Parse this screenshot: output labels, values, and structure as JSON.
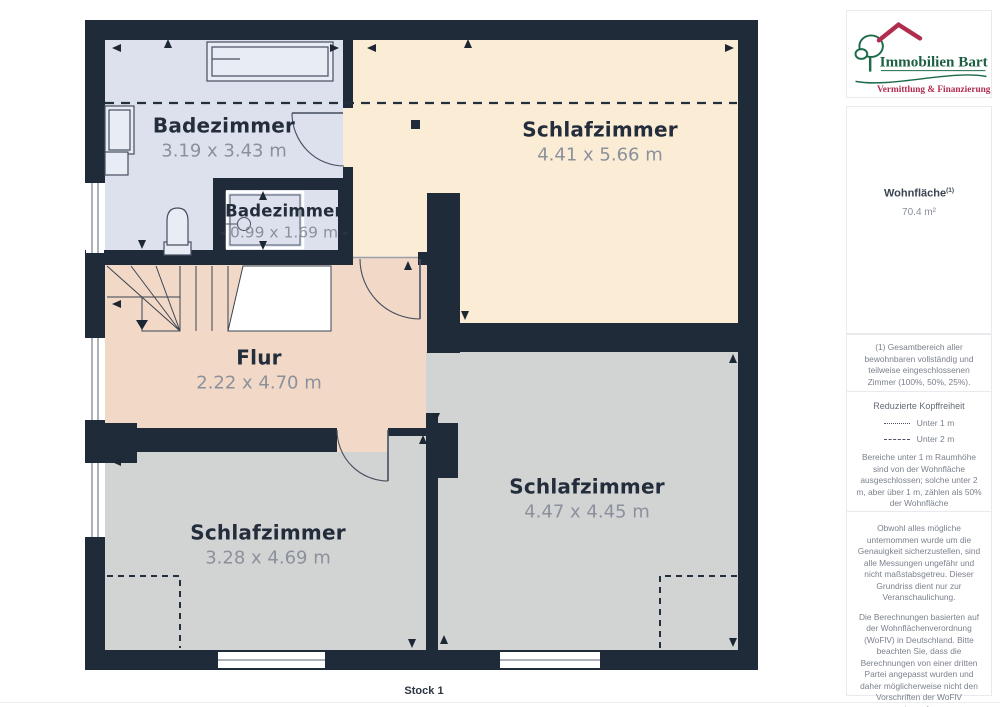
{
  "page": {
    "floor_label": "Stock 1"
  },
  "colors": {
    "wall": "#202b39",
    "bathroom_floor": "#dce1ed",
    "bedroom_cream": "#fbecd5",
    "flur_floor": "#f2d9c7",
    "bedroom_gray": "#d2d3d3",
    "brand_green": "#1d6a48",
    "brand_red": "#b02d4e"
  },
  "icons": {
    "dim_arrow_left": "◄",
    "dim_arrow_right": "►"
  },
  "branding": {
    "name": "Immobilien Bart",
    "tagline": "Vermittlung & Finanzierung"
  },
  "rooms": [
    {
      "name": "Badezimmer",
      "dims": "3.19 x 3.43 m"
    },
    {
      "name": "Badezimmer",
      "dims": "0.99 x 1.69 m"
    },
    {
      "name": "Schlafzimmer",
      "dims": "4.41 x 5.66 m"
    },
    {
      "name": "Flur",
      "dims": "2.22 x 4.70 m"
    },
    {
      "name": "Schlafzimmer",
      "dims": "3.28 x 4.69 m"
    },
    {
      "name": "Schlafzimmer",
      "dims": "4.47 x 4.45 m"
    }
  ],
  "sidebar": {
    "area_title": "Wohnfläche",
    "area_title_sup": "(1)",
    "area_value": "70.4 m²",
    "footnote": "(1) Gesamtbereich aller bewohnbaren vollständig und teilweise eingeschlossenen Zimmer (100%, 50%, 25%).",
    "headroom": {
      "title": "Reduzierte Kopffreiheit",
      "legend": [
        {
          "style": "dotted",
          "label": "Unter 1 m"
        },
        {
          "style": "dashed",
          "label": "Unter 2 m"
        }
      ],
      "note": "Bereiche unter 1 m Raumhöhe sind von der Wohnfläche ausgeschlossen; solche unter 2 m, aber über 1 m, zählen als 50% der Wohnfläche"
    },
    "disclaimer1": "Obwohl alles mögliche unternommen wurde um die Genauigkeit sicherzustellen, sind alle Messungen ungefähr und nicht maßstabsgetreu. Dieser Grundriss dient nur zur Veranschaulichung.",
    "disclaimer2": "Die Berechnungen basierten auf der Wohnflächenverordnung (WoFlV) in Deutschland. Bitte beachten Sie, dass die Berechnungen von einer dritten Partei angepasst wurden und daher möglicherweise nicht den Vorschriften der WoFlV entsprechen.",
    "brand_footer_regular": "GIRAFFE",
    "brand_footer_bold": "360"
  }
}
